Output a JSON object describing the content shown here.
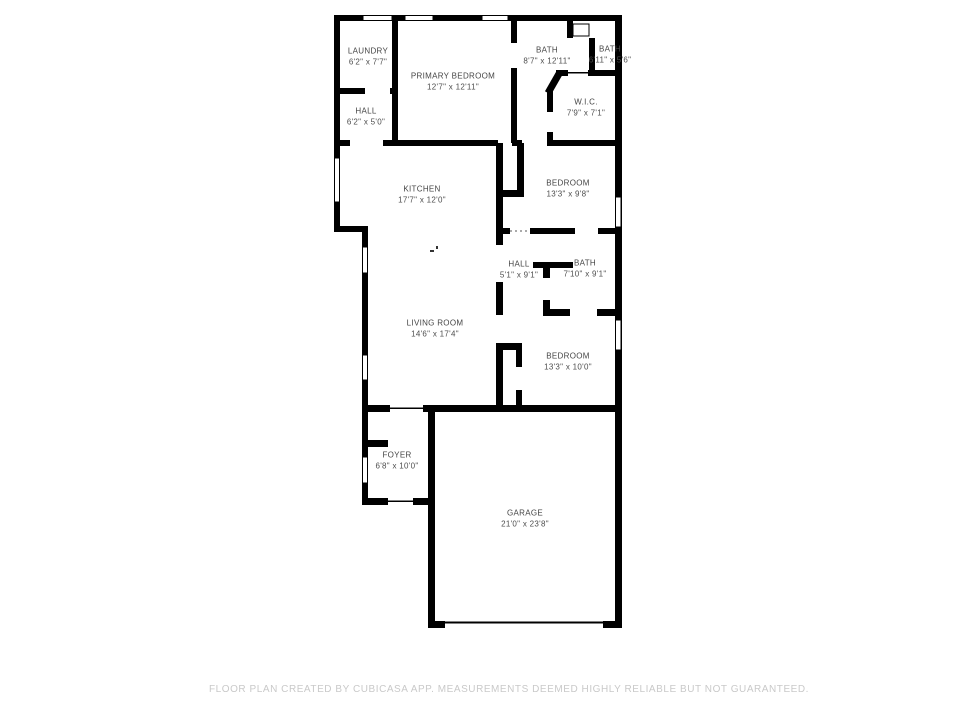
{
  "footer": {
    "text": "FLOOR PLAN CREATED BY CUBICASA APP. MEASUREMENTS DEEMED HIGHLY RELIABLE BUT NOT GUARANTEED."
  },
  "floor_plan": {
    "wall_color": "#000000",
    "label_color": "#454545",
    "footer_color": "#c9c9c9",
    "rooms": [
      {
        "name": "LAUNDRY",
        "dims": "6'2\" x 7'7\""
      },
      {
        "name": "HALL",
        "dims": "6'2\" x 5'0\""
      },
      {
        "name": "PRIMARY BEDROOM",
        "dims": "12'7\" x 12'11\""
      },
      {
        "name": "BATH",
        "dims": "8'7\" x 12'11\""
      },
      {
        "name": "BATH",
        "dims": "6'11\" x 5'6\""
      },
      {
        "name": "W.I.C.",
        "dims": "7'9\" x 7'1\""
      },
      {
        "name": "KITCHEN",
        "dims": "17'7\" x 12'0\""
      },
      {
        "name": "BEDROOM",
        "dims": "13'3\" x 9'8\""
      },
      {
        "name": "HALL",
        "dims": "5'1\" x 9'1\""
      },
      {
        "name": "BATH",
        "dims": "7'10\" x 9'1\""
      },
      {
        "name": "LIVING ROOM",
        "dims": "14'6\" x 17'4\""
      },
      {
        "name": "BEDROOM",
        "dims": "13'3\" x 10'0\""
      },
      {
        "name": "FOYER",
        "dims": "6'8\" x 10'0\""
      },
      {
        "name": "GARAGE",
        "dims": "21'0\" x 23'8\""
      }
    ]
  }
}
